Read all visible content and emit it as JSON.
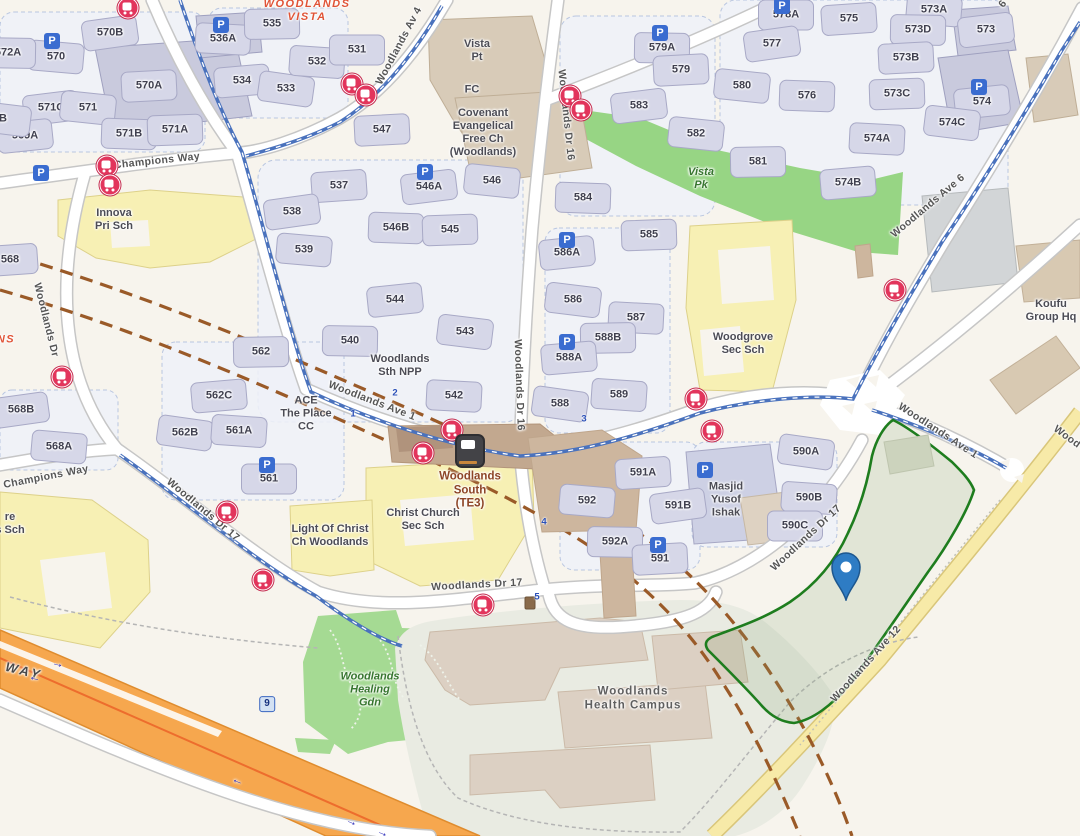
{
  "colors": {
    "background": "#f7f4ed",
    "site_outline_green": "#1e7d1e",
    "site_fill_green": "#7ea06f",
    "pin_blue": "#2e7cc4",
    "expressway_orange": "#f6a74e",
    "road_yellow": "#f7eaa8",
    "cycling_path_blue": "#4a72bd",
    "railway_brown": "#9a5a28",
    "bus_stop_red": "#e2355c",
    "parking_blue": "#3a6cd0",
    "park_green": "#97d584",
    "school_yellow": "#f7f0b4",
    "block_fill": "#d6d7e8"
  },
  "labels": {
    "blocks": [
      {
        "t": "570B",
        "x": 110,
        "y": 33
      },
      {
        "t": "570",
        "x": 56,
        "y": 57
      },
      {
        "t": "572A",
        "x": 8,
        "y": 53
      },
      {
        "t": "570A",
        "x": 149,
        "y": 86
      },
      {
        "t": "571C",
        "x": 51,
        "y": 108
      },
      {
        "t": "571",
        "x": 88,
        "y": 108
      },
      {
        "t": "571B",
        "x": 129,
        "y": 134
      },
      {
        "t": "571A",
        "x": 175,
        "y": 130
      },
      {
        "t": "569A",
        "x": 25,
        "y": 136
      },
      {
        "t": "B",
        "x": 3,
        "y": 119
      },
      {
        "t": "536A",
        "x": 223,
        "y": 39
      },
      {
        "t": "535",
        "x": 272,
        "y": 24
      },
      {
        "t": "534",
        "x": 242,
        "y": 81
      },
      {
        "t": "533",
        "x": 286,
        "y": 89
      },
      {
        "t": "532",
        "x": 317,
        "y": 62
      },
      {
        "t": "531",
        "x": 357,
        "y": 50
      },
      {
        "t": "537",
        "x": 339,
        "y": 186
      },
      {
        "t": "538",
        "x": 292,
        "y": 212
      },
      {
        "t": "539",
        "x": 304,
        "y": 250
      },
      {
        "t": "540",
        "x": 350,
        "y": 341
      },
      {
        "t": "547",
        "x": 382,
        "y": 130
      },
      {
        "t": "546A",
        "x": 429,
        "y": 187
      },
      {
        "t": "546",
        "x": 492,
        "y": 181
      },
      {
        "t": "546B",
        "x": 396,
        "y": 228
      },
      {
        "t": "545",
        "x": 450,
        "y": 230
      },
      {
        "t": "544",
        "x": 395,
        "y": 300
      },
      {
        "t": "543",
        "x": 465,
        "y": 332
      },
      {
        "t": "542",
        "x": 454,
        "y": 396
      },
      {
        "t": "562",
        "x": 261,
        "y": 352
      },
      {
        "t": "562C",
        "x": 219,
        "y": 396
      },
      {
        "t": "562B",
        "x": 185,
        "y": 433
      },
      {
        "t": "561A",
        "x": 239,
        "y": 431
      },
      {
        "t": "561",
        "x": 269,
        "y": 479
      },
      {
        "t": "568",
        "x": 10,
        "y": 260
      },
      {
        "t": "568B",
        "x": 21,
        "y": 410
      },
      {
        "t": "568A",
        "x": 59,
        "y": 447
      },
      {
        "t": "579A",
        "x": 662,
        "y": 48
      },
      {
        "t": "579",
        "x": 681,
        "y": 70
      },
      {
        "t": "583",
        "x": 639,
        "y": 106
      },
      {
        "t": "582",
        "x": 696,
        "y": 134
      },
      {
        "t": "584",
        "x": 583,
        "y": 198
      },
      {
        "t": "585",
        "x": 649,
        "y": 235
      },
      {
        "t": "586A",
        "x": 567,
        "y": 253
      },
      {
        "t": "586",
        "x": 573,
        "y": 300
      },
      {
        "t": "587",
        "x": 636,
        "y": 318
      },
      {
        "t": "588B",
        "x": 608,
        "y": 338
      },
      {
        "t": "588A",
        "x": 569,
        "y": 358
      },
      {
        "t": "588",
        "x": 560,
        "y": 404
      },
      {
        "t": "589",
        "x": 619,
        "y": 395
      },
      {
        "t": "578A",
        "x": 786,
        "y": 15
      },
      {
        "t": "575",
        "x": 849,
        "y": 19
      },
      {
        "t": "577",
        "x": 772,
        "y": 44
      },
      {
        "t": "573A",
        "x": 934,
        "y": 10
      },
      {
        "t": "573D",
        "x": 918,
        "y": 30
      },
      {
        "t": "573B",
        "x": 906,
        "y": 58
      },
      {
        "t": "573",
        "x": 986,
        "y": 30
      },
      {
        "t": "580",
        "x": 742,
        "y": 86
      },
      {
        "t": "576",
        "x": 807,
        "y": 96
      },
      {
        "t": "573C",
        "x": 897,
        "y": 94
      },
      {
        "t": "574",
        "x": 982,
        "y": 102
      },
      {
        "t": "574C",
        "x": 952,
        "y": 123
      },
      {
        "t": "574A",
        "x": 877,
        "y": 139
      },
      {
        "t": "581",
        "x": 758,
        "y": 162
      },
      {
        "t": "574B",
        "x": 848,
        "y": 183
      },
      {
        "t": "590A",
        "x": 806,
        "y": 452
      },
      {
        "t": "590B",
        "x": 809,
        "y": 498
      },
      {
        "t": "590C",
        "x": 795,
        "y": 526
      },
      {
        "t": "591A",
        "x": 643,
        "y": 473
      },
      {
        "t": "591B",
        "x": 678,
        "y": 506
      },
      {
        "t": "592",
        "x": 587,
        "y": 501
      },
      {
        "t": "592A",
        "x": 615,
        "y": 542
      },
      {
        "t": "591",
        "x": 660,
        "y": 559
      }
    ],
    "roads": [
      {
        "t": "Woodlands Av 4",
        "x": 399,
        "y": 46,
        "r": -62
      },
      {
        "t": "Champions Way",
        "x": 157,
        "y": 161,
        "r": -6
      },
      {
        "t": "Champions Way",
        "x": 46,
        "y": 477,
        "r": -11
      },
      {
        "t": "Woodlands Dr",
        "x": 46,
        "y": 320,
        "r": 76
      },
      {
        "t": "Woodlands Dr 16",
        "x": 566,
        "y": 115,
        "r": 84
      },
      {
        "t": "Woodlands Dr 16",
        "x": 519,
        "y": 385,
        "r": 88
      },
      {
        "t": "Woodlands Ave 1",
        "x": 372,
        "y": 401,
        "r": 21
      },
      {
        "t": "Woodlands Ave 1",
        "x": 938,
        "y": 431,
        "r": 33
      },
      {
        "t": "Woodlands Ave 6",
        "x": 928,
        "y": 206,
        "r": -40
      },
      {
        "t": "Woodlands Dr 17",
        "x": 203,
        "y": 510,
        "r": 40
      },
      {
        "t": "Woodlands Dr 17",
        "x": 477,
        "y": 585,
        "r": -3
      },
      {
        "t": "Woodlands Dr 17",
        "x": 806,
        "y": 538,
        "r": -43
      },
      {
        "t": "Woodlands Ave 12",
        "x": 866,
        "y": 664,
        "r": -48
      },
      {
        "t": "Wood",
        "x": 1067,
        "y": 437,
        "r": 36
      },
      {
        "t": "6",
        "x": 1003,
        "y": 4,
        "r": -55
      },
      {
        "t": "WAY",
        "x": 24,
        "y": 671,
        "r": 14,
        "c": "expwy"
      }
    ],
    "places": [
      {
        "t": "WOODLANDS\nVISTA",
        "x": 307,
        "y": 11,
        "c": "estate"
      },
      {
        "t": "NS",
        "x": 6,
        "y": 340,
        "c": "estate"
      },
      {
        "t": "Vista\nPt",
        "x": 477,
        "y": 51,
        "c": "poi"
      },
      {
        "t": "FC",
        "x": 472,
        "y": 90,
        "c": "poi"
      },
      {
        "t": "Covenant\nEvangelical\nFree Ch\n(Woodlands)",
        "x": 483,
        "y": 133,
        "c": "poi"
      },
      {
        "t": "Innova\nPri Sch",
        "x": 114,
        "y": 220,
        "c": "poi"
      },
      {
        "t": "Woodlands\nSth NPP",
        "x": 400,
        "y": 366,
        "c": "poi"
      },
      {
        "t": "ACE\nThe Place\nCC",
        "x": 306,
        "y": 414,
        "c": "poi"
      },
      {
        "t": "Woodgrove\nSec Sch",
        "x": 743,
        "y": 344,
        "c": "poi"
      },
      {
        "t": "Koufu\nGroup Hq",
        "x": 1051,
        "y": 311,
        "c": "poi"
      },
      {
        "t": "Masjid\nYusof\nIshak",
        "x": 726,
        "y": 500,
        "c": "poi"
      },
      {
        "t": "Christ Church\nSec Sch",
        "x": 423,
        "y": 520,
        "c": "poi"
      },
      {
        "t": "Light Of Christ\nCh Woodlands",
        "x": 330,
        "y": 536,
        "c": "poi"
      },
      {
        "t": "re\ns Sch",
        "x": 10,
        "y": 524,
        "c": "poi"
      },
      {
        "t": "Vista\nPk",
        "x": 701,
        "y": 179,
        "c": "park"
      },
      {
        "t": "Woodlands\nHealing\nGdn",
        "x": 370,
        "y": 690,
        "c": "park"
      },
      {
        "t": "Woodlands\nHealth Campus",
        "x": 633,
        "y": 699,
        "c": "campus"
      },
      {
        "t": "Woodlands\nSouth\n(TE3)",
        "x": 470,
        "y": 491,
        "c": "mrt"
      }
    ]
  },
  "icons": {
    "bus_stops": [
      {
        "x": 128,
        "y": 8
      },
      {
        "x": 352,
        "y": 84
      },
      {
        "x": 366,
        "y": 95
      },
      {
        "x": 570,
        "y": 96
      },
      {
        "x": 581,
        "y": 110
      },
      {
        "x": 107,
        "y": 166
      },
      {
        "x": 110,
        "y": 185
      },
      {
        "x": 62,
        "y": 377
      },
      {
        "x": 452,
        "y": 430
      },
      {
        "x": 423,
        "y": 453
      },
      {
        "x": 696,
        "y": 399
      },
      {
        "x": 712,
        "y": 431
      },
      {
        "x": 895,
        "y": 290
      },
      {
        "x": 227,
        "y": 512
      },
      {
        "x": 263,
        "y": 580
      },
      {
        "x": 483,
        "y": 605
      }
    ],
    "parking": [
      {
        "t": "P",
        "x": 52,
        "y": 41
      },
      {
        "t": "P",
        "x": 41,
        "y": 173
      },
      {
        "t": "P",
        "x": 221,
        "y": 25
      },
      {
        "t": "P",
        "x": 425,
        "y": 172
      },
      {
        "t": "P",
        "x": 660,
        "y": 33
      },
      {
        "t": "P",
        "x": 567,
        "y": 240
      },
      {
        "t": "P",
        "x": 567,
        "y": 342
      },
      {
        "t": "P",
        "x": 267,
        "y": 465
      },
      {
        "t": "P",
        "x": 658,
        "y": 545
      },
      {
        "t": "P",
        "x": 705,
        "y": 470
      },
      {
        "t": "P",
        "x": 979,
        "y": 87
      },
      {
        "t": "P",
        "x": 782,
        "y": 6
      }
    ],
    "route_markers": [
      {
        "t": "1",
        "x": 353,
        "y": 414
      },
      {
        "t": "2",
        "x": 395,
        "y": 393
      },
      {
        "t": "3",
        "x": 584,
        "y": 419
      },
      {
        "t": "4",
        "x": 544,
        "y": 522
      },
      {
        "t": "5",
        "x": 537,
        "y": 597
      },
      {
        "t": "9",
        "x": 267,
        "y": 704,
        "c": "boxed"
      }
    ],
    "arrows": [
      {
        "t": "→",
        "x": 58,
        "y": 663,
        "r": 14
      },
      {
        "t": "←",
        "x": 35,
        "y": 677,
        "r": 14
      },
      {
        "t": "←",
        "x": 238,
        "y": 780,
        "r": 22
      },
      {
        "t": "→",
        "x": 352,
        "y": 821,
        "r": 22
      },
      {
        "t": "→",
        "x": 383,
        "y": 832,
        "r": 22
      }
    ],
    "mrt": {
      "x": 470,
      "y": 451
    },
    "poi_brown": {
      "x": 530,
      "y": 603
    },
    "pin": {
      "x": 846,
      "y": 601
    }
  }
}
